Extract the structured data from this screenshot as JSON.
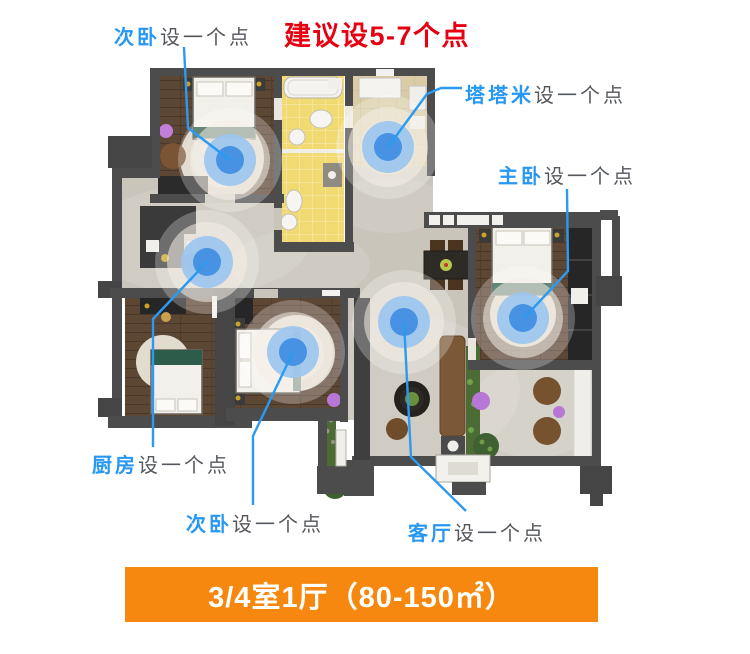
{
  "title": {
    "text": "建议设5-7个点",
    "color": "#e60012"
  },
  "labels": [
    {
      "id": "bedroom-top",
      "room": "次卧",
      "note": "设一个点"
    },
    {
      "id": "tatami",
      "room": "塔塔米",
      "note": "设一个点"
    },
    {
      "id": "master",
      "room": "主卧",
      "note": "设一个点"
    },
    {
      "id": "kitchen",
      "room": "厨房",
      "note": "设一个点"
    },
    {
      "id": "bedroom-bottom",
      "room": "次卧",
      "note": "设一个点"
    },
    {
      "id": "living",
      "room": "客厅",
      "note": "设一个点"
    }
  ],
  "banner": {
    "text": "3/4室1厅（80-150㎡）",
    "bg": "#f6880f",
    "text_color": "#ffffff"
  },
  "colors": {
    "label_room": "#2797f4",
    "label_note": "#54575c",
    "leader": "#2b9af0",
    "wifi_core": "#4792e2",
    "wifi_mid": "#9cc5ef",
    "wall": "#4c4c4c",
    "marble_floor": "#cac5bb",
    "wood_floor": "#5c4634",
    "bath_tile": "#f1da72",
    "tatami_floor": "#d9cca7"
  },
  "access_points": [
    {
      "id": "bedroom-top",
      "room": "次卧",
      "x": 230,
      "y": 160,
      "leader": "184,47 188,128 230,160"
    },
    {
      "id": "tatami",
      "room": "塔塔米",
      "x": 388,
      "y": 147,
      "leader": "388,147 427,94 441,88 462,88"
    },
    {
      "id": "kitchen",
      "room": "厨房",
      "x": 207,
      "y": 262,
      "leader": "207,262 153,319 153,447"
    },
    {
      "id": "bedroom-bottom",
      "room": "次卧",
      "x": 293,
      "y": 352,
      "leader": "293,352 253,436 253,505"
    },
    {
      "id": "living",
      "room": "客厅",
      "x": 404,
      "y": 322,
      "leader": "404,322 411,457 466,511"
    },
    {
      "id": "master",
      "room": "主卧",
      "x": 523,
      "y": 318,
      "leader": "567,189 568,271 525,317"
    }
  ]
}
